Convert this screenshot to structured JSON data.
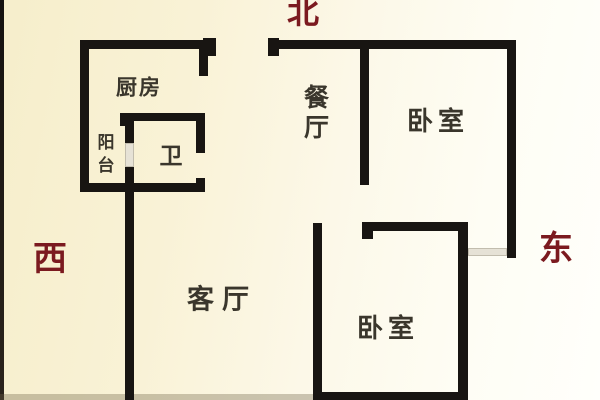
{
  "compass": {
    "color": "#7b1a1f",
    "north": {
      "label": "北"
    },
    "west": {
      "label": "西"
    },
    "east": {
      "label": "东"
    }
  },
  "rooms": {
    "kitchen": {
      "label": "厨房"
    },
    "balcony": {
      "label": "阳台"
    },
    "bathroom": {
      "label": "卫"
    },
    "dining": {
      "label": "餐厅"
    },
    "bedroom_north": {
      "label": "卧室"
    },
    "living": {
      "label": "客厅"
    },
    "bedroom_south": {
      "label": "卧室"
    }
  },
  "plan": {
    "wall_color": "#181512",
    "opening_color": "#e6e2d6",
    "shadow_color": "rgba(110,98,70,0.35)",
    "walls": [
      {
        "name": "kitchen-top-wall",
        "x": 80,
        "y": 40,
        "w": 136,
        "h": 9
      },
      {
        "name": "kitchen-top-wall-end-cap",
        "x": 203,
        "y": 38,
        "w": 13,
        "h": 18
      },
      {
        "name": "west-outer-wall",
        "x": 80,
        "y": 40,
        "w": 9,
        "h": 150
      },
      {
        "name": "balcony-bottom-wall",
        "x": 80,
        "y": 183,
        "w": 54,
        "h": 9
      },
      {
        "name": "kitchen-right-wall-upper",
        "x": 199,
        "y": 49,
        "w": 9,
        "h": 27
      },
      {
        "name": "bathroom-top-wall",
        "x": 120,
        "y": 113,
        "w": 85,
        "h": 8
      },
      {
        "name": "bathroom-top-left-cap",
        "x": 120,
        "y": 113,
        "w": 9,
        "h": 13
      },
      {
        "name": "bathroom-top-right-cap",
        "x": 196,
        "y": 113,
        "w": 9,
        "h": 14
      },
      {
        "name": "bathroom-right-wall",
        "x": 196,
        "y": 127,
        "w": 9,
        "h": 26
      },
      {
        "name": "bathroom-right-wall-nub",
        "x": 196,
        "y": 178,
        "w": 9,
        "h": 14
      },
      {
        "name": "bathroom-bottom-wall",
        "x": 125,
        "y": 183,
        "w": 80,
        "h": 9
      },
      {
        "name": "balcony-divider-wall-upper",
        "x": 125,
        "y": 121,
        "w": 9,
        "h": 22
      },
      {
        "name": "living-room-left-wall",
        "x": 125,
        "y": 167,
        "w": 9,
        "h": 233
      },
      {
        "name": "north-wall-left-cap",
        "x": 268,
        "y": 38,
        "w": 11,
        "h": 18
      },
      {
        "name": "north-outer-wall",
        "x": 268,
        "y": 40,
        "w": 248,
        "h": 9
      },
      {
        "name": "dining-bedroom-divider-wall",
        "x": 360,
        "y": 49,
        "w": 9,
        "h": 136
      },
      {
        "name": "east-outer-wall",
        "x": 507,
        "y": 40,
        "w": 9,
        "h": 218
      },
      {
        "name": "living-room-east-wall",
        "x": 313,
        "y": 223,
        "w": 9,
        "h": 177
      },
      {
        "name": "bedroom-south-top-wall",
        "x": 362,
        "y": 222,
        "w": 106,
        "h": 9
      },
      {
        "name": "bedroom-south-top-left-nub",
        "x": 362,
        "y": 222,
        "w": 11,
        "h": 17
      },
      {
        "name": "bedroom-south-right-wall",
        "x": 458,
        "y": 222,
        "w": 10,
        "h": 178
      },
      {
        "name": "bedroom-south-bottom-wall",
        "x": 322,
        "y": 392,
        "w": 136,
        "h": 8
      }
    ],
    "openings": [
      {
        "name": "balcony-door-opening",
        "x": 125,
        "y": 143,
        "w": 9,
        "h": 24
      },
      {
        "name": "east-window",
        "x": 468,
        "y": 248,
        "w": 39,
        "h": 8
      }
    ],
    "shadows": [
      {
        "name": "bottom-edge-shadow",
        "x": 0,
        "y": 394,
        "w": 313,
        "h": 6
      }
    ]
  }
}
